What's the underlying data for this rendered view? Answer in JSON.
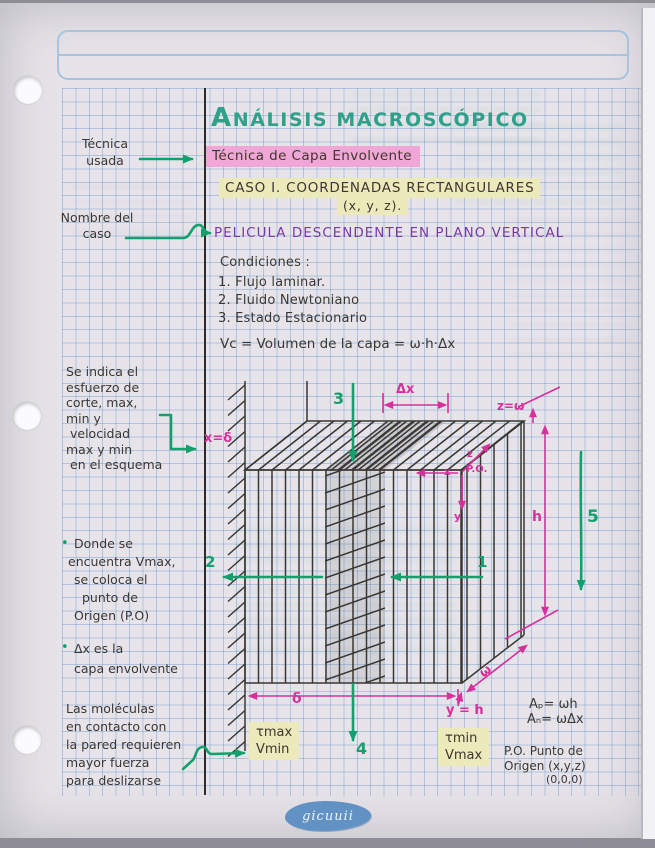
{
  "colors": {
    "title_green": "#2fa189",
    "marker_green": "#13a06c",
    "annotation_pink": "#d6309b",
    "highlight_pink": "#f0a6d6",
    "highlight_yellow": "#ece9ba",
    "heading_purple": "#7a3aa5",
    "ink": "#3b3733",
    "grid_blue": "#9db9dd"
  },
  "title": "ANÁLISIS MACROSCÓPICO",
  "bullet": "•",
  "main": {
    "technique": "Técnica de Capa Envolvente",
    "case_heading": "CASO I. COORDENADAS RECTANGULARES",
    "case_coords": "(x, y, z).",
    "film_heading": "PELICULA DESCENDENTE EN PLANO VERTICAL",
    "conditions_title": "Condiciones :",
    "conditions": [
      "1. Flujo laminar.",
      "2. Fluido Newtoniano",
      "3. Estado Estacionario"
    ],
    "volume_formula": "Vc = Volumen de la capa = ω·h·Δx"
  },
  "margin_notes": {
    "technique_used": [
      "Técnica",
      "usada"
    ],
    "case_name": [
      "Nombre del",
      "caso"
    ],
    "stress_note": [
      "Se indica el",
      "esfuerzo de",
      "corte, max,",
      "min y",
      "velocidad",
      "max y min",
      "en el esquema"
    ],
    "vmax_note": [
      "Donde se",
      "encuentra Vmax,",
      "se coloca el",
      "punto de",
      "Origen (P.O)"
    ],
    "dx_note": [
      "Δx es la",
      "capa envolvente"
    ],
    "molecules_note": [
      "Las moléculas",
      "en contacto con",
      "la pared requieren",
      "mayor fuerza",
      "para deslizarse"
    ]
  },
  "diagram": {
    "dx": "Δx",
    "z_eq_omega": "z=ω",
    "x_eq_delta": "x=δ",
    "po": "P.O.",
    "axis_x": "x",
    "axis_y": "y",
    "axis_z": "z",
    "h": "h",
    "delta": "δ",
    "omega": "ω",
    "y_eq_h": "y = h",
    "n1": "1",
    "n2": "2",
    "n3": "3",
    "n4": "4",
    "n5": "5",
    "tau_max": "τmax",
    "v_min": "Vmin",
    "tau_min": "τmin",
    "v_max": "Vmax"
  },
  "formulas": {
    "area_p": "Aₚ= ωh",
    "area_n": "Aₙ= ωΔx",
    "po_def": [
      "P.O. Punto de",
      "Origen (x,y,z)",
      "(0,0,0)"
    ]
  },
  "logo": "gicuuii"
}
